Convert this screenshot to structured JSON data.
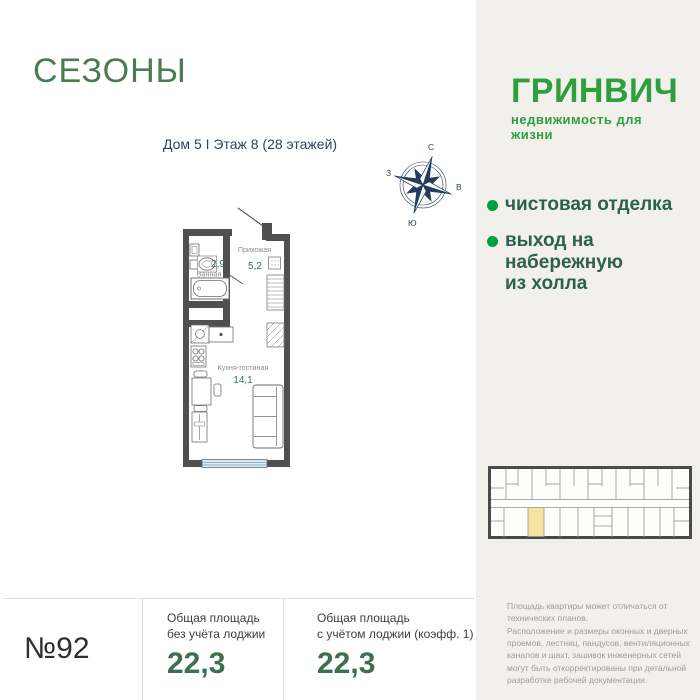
{
  "header": {
    "project": "СЕЗОНЫ",
    "location": "Дом 5 I Этаж 8 (28 этажей)"
  },
  "brand": {
    "name": "ГРИНВИЧ",
    "tagline": "недвижимость для жизни"
  },
  "compass": {
    "north": "С",
    "east": "В",
    "south": "Ю",
    "west": "З"
  },
  "features": {
    "item1": "чистовая отделка",
    "item2": "выход на\nнабережную\nиз холла"
  },
  "floorplan": {
    "rooms": {
      "hallway": {
        "name": "Прихожая",
        "area": "5,2"
      },
      "bathroom": {
        "name": "Ванная",
        "area": "2,9"
      },
      "kitchen_living": {
        "name": "Кухня-гостиная",
        "area": "14,1"
      }
    }
  },
  "summary": {
    "apartment_number": "№92",
    "metric1": {
      "label": "Общая площадь\nбез учёта лоджии",
      "value": "22,3"
    },
    "metric2": {
      "label": "Общая площадь\nс учётом лоджии (коэфф. 1)",
      "value": "22,3"
    }
  },
  "disclaimer": "Площадь квартиры может отличаться от технических планов.\nРасположение и размеры оконных и дверных проемов, лестниц, пандусов, вентиляционных каналов и шахт, зашивок инженерных сетей могут быть откорректированы при детальной разработке рабочей документации.",
  "colors": {
    "panel_bg": "#f2f0ea",
    "seasons_green": "#4a7b52",
    "brand_green": "#2f9e3f",
    "bullet_green": "#00a040",
    "feature_green": "#2c614a",
    "value_green": "#3e7050",
    "navy": "#2a4562",
    "wall_gray": "#4f4f4f",
    "window_blue": "#d9ecf7",
    "unit_highlight": "#f8e2a2"
  }
}
